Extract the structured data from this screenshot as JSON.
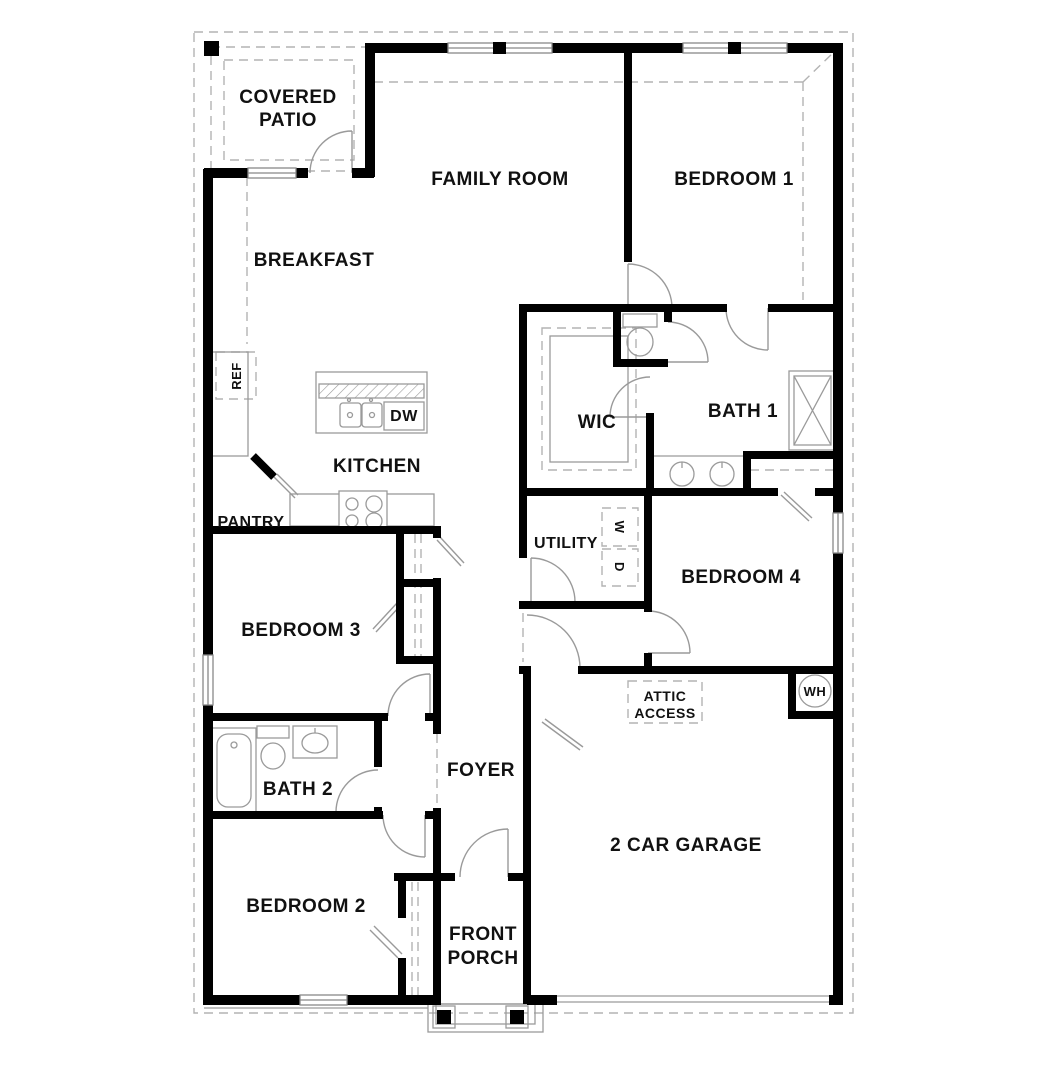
{
  "plan": {
    "type": "residential-floor-plan",
    "rooms": {
      "covered_patio": {
        "l1": "COVERED",
        "l2": "PATIO"
      },
      "family_room": "FAMILY ROOM",
      "bedroom1": "BEDROOM 1",
      "breakfast": "BREAKFAST",
      "kitchen": "KITCHEN",
      "wic": "WIC",
      "bath1": "BATH 1",
      "pantry": "PANTRY",
      "utility": "UTILITY",
      "bedroom4": "BEDROOM 4",
      "bedroom3": "BEDROOM 3",
      "foyer": "FOYER",
      "bath2": "BATH 2",
      "bedroom2": "BEDROOM 2",
      "garage": "2 CAR GARAGE",
      "front_porch": {
        "l1": "FRONT",
        "l2": "PORCH"
      }
    },
    "features": {
      "attic_access": {
        "l1": "ATTIC",
        "l2": "ACCESS"
      },
      "water_heater": "WH",
      "refrigerator": "REF",
      "dishwasher": "DW",
      "washer": "W",
      "dryer": "D"
    },
    "colors": {
      "wall": "#000000",
      "fixture": "#9a9a9a",
      "dashed": "#b3b3b3",
      "label": "#111111",
      "background": "#ffffff"
    }
  }
}
